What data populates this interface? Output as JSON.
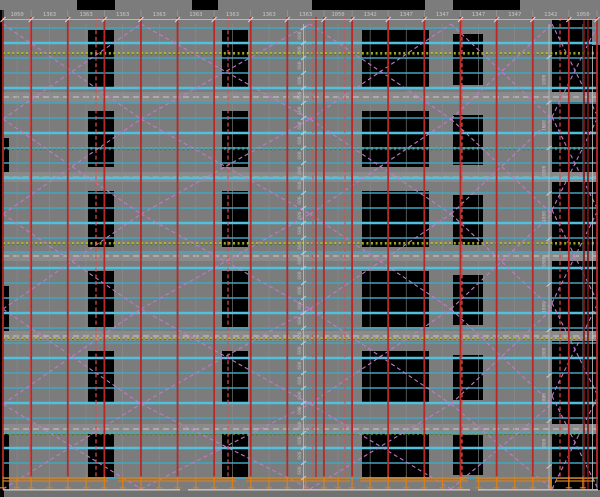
{
  "drawing": {
    "title": "scaffold-elevation-cad-drawing",
    "type": "cad-elevation",
    "top_dimension_labels": [
      "1050",
      "1363",
      "1363",
      "1363",
      "1363",
      "1363",
      "1363",
      "1363",
      "1363",
      "1050",
      "1342",
      "1347",
      "1347",
      "1347",
      "1347",
      "1342",
      "1050"
    ],
    "mid_vertical_dimension": {
      "label": "600",
      "count": 30
    },
    "right_vertical_dimension": {
      "label": "1800",
      "count": 9
    }
  },
  "colors": {
    "wall_gray": "#7c7c7c",
    "void_black": "#000000",
    "ledger_cyan": "#3fa6c2",
    "ledger_cyan_bright": "#4fc0dd",
    "standard_red": "#b62a2a",
    "standard_red_dashed": "#e04c4c",
    "dark_red": "#7c1818",
    "brace_magenta": "#c478cc",
    "tie_yellow_green": "#b9bd2c",
    "tie_dark_green": "#54761e",
    "grid_light": "#949494",
    "band_gray": "#8a8a8a",
    "white_line": "#c9c9c9",
    "dim_text": "#c8c8c8",
    "base_orange": "#d6801e",
    "bottom_strip": "#717171"
  }
}
